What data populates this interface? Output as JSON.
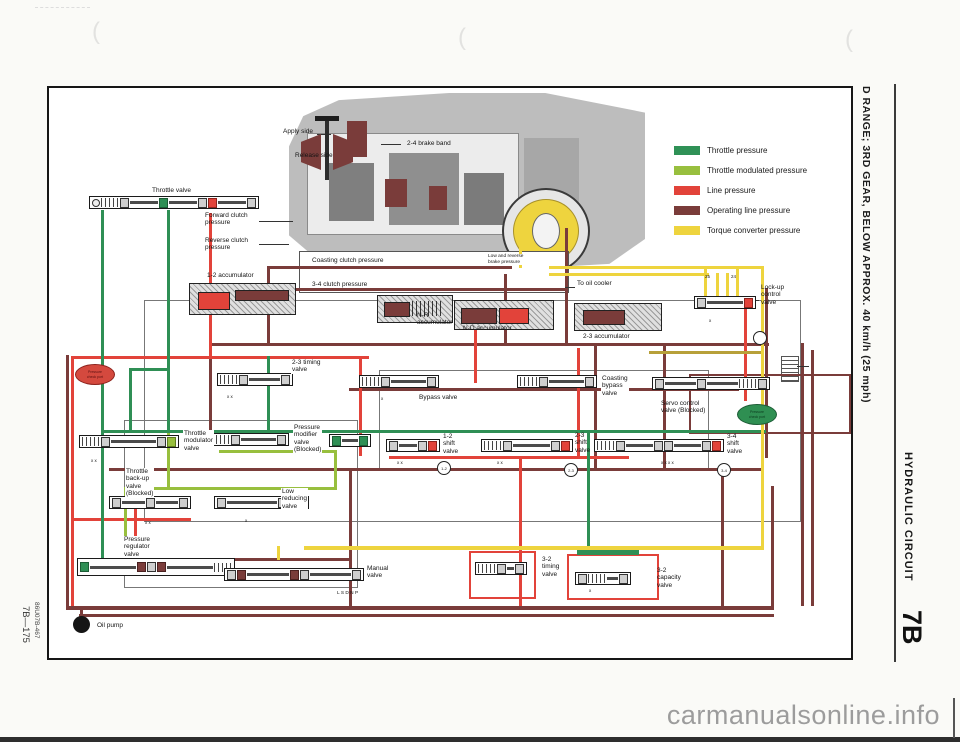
{
  "page": {
    "margin_left": {
      "page_number": "7B—175",
      "figure_code": "86U07B-467"
    },
    "margin_right": {
      "caption": "D RANGE; 3RD GEAR, BELOW APPROX. 40 km/h (25 mph)",
      "section_title": "HYDRAULIC CIRCUIT",
      "section_number": "7B"
    },
    "watermark": "carmanualsonline.info"
  },
  "legend": {
    "items": [
      {
        "label": "Throttle pressure",
        "color": "#2f9156"
      },
      {
        "label": "Throttle modulated pressure",
        "color": "#98bf3e"
      },
      {
        "label": "Line pressure",
        "color": "#e2433a"
      },
      {
        "label": "Operating line pressure",
        "color": "#7a3c3a"
      },
      {
        "label": "Torque converter pressure",
        "color": "#eed43e"
      }
    ]
  },
  "diagram": {
    "labels": [
      {
        "t": "Apply side",
        "x": 234,
        "y": 40
      },
      {
        "t": "Release side",
        "x": 246,
        "y": 64
      },
      {
        "t": "2-4 brake band",
        "x": 358,
        "y": 52
      },
      {
        "t": "Throttle valve",
        "x": 103,
        "y": 99
      },
      {
        "t": "Forward clutch\npressure",
        "x": 156,
        "y": 124
      },
      {
        "t": "Reverse clutch\npressure",
        "x": 156,
        "y": 149
      },
      {
        "t": "1-2 accumulator",
        "x": 158,
        "y": 184
      },
      {
        "t": "Coasting clutch pressure",
        "x": 262,
        "y": 169,
        "bg": 1
      },
      {
        "t": "Low and reverse\nbrake pressure",
        "x": 438,
        "y": 166,
        "s": 4.8,
        "bg": 1
      },
      {
        "t": "3-4 clutch pressure",
        "x": 262,
        "y": 193,
        "bg": 1
      },
      {
        "t": "To oil cooler",
        "x": 528,
        "y": 192
      },
      {
        "t": "N-R\naccumulator",
        "x": 368,
        "y": 224
      },
      {
        "t": "N-D accumulator",
        "x": 414,
        "y": 237
      },
      {
        "t": "2-3 accumulator",
        "x": 534,
        "y": 245
      },
      {
        "t": "Lock-up\ncontrol\nvalve",
        "x": 712,
        "y": 196
      },
      {
        "t": "2-3 timing\nvalve",
        "x": 242,
        "y": 271,
        "bg": 1
      },
      {
        "t": "Bypass valve",
        "x": 370,
        "y": 306
      },
      {
        "t": "Coasting\nbypass\nvalve",
        "x": 552,
        "y": 287,
        "bg": 1
      },
      {
        "t": "Servo control\nvalve (Blocked)",
        "x": 612,
        "y": 312
      },
      {
        "t": "Throttle\nmodulator\nvalve",
        "x": 134,
        "y": 342,
        "bg": 1
      },
      {
        "t": "Pressure\nmodifier\nvalve\n(Blocked)",
        "x": 244,
        "y": 336,
        "bg": 1
      },
      {
        "t": "1-2\nshift\nvalve",
        "x": 394,
        "y": 345
      },
      {
        "t": "2-3\nshift\nvalve",
        "x": 526,
        "y": 344
      },
      {
        "t": "3-4\nshift\nvalve",
        "x": 678,
        "y": 345
      },
      {
        "t": "Throttle\nback-up\nvalve\n(Blocked)",
        "x": 76,
        "y": 380,
        "bg": 1
      },
      {
        "t": "Low\nreducing\nvalve",
        "x": 232,
        "y": 400,
        "bg": 1
      },
      {
        "t": "Pressure\nregulator\nvalve",
        "x": 74,
        "y": 448,
        "bg": 1
      },
      {
        "t": "Manual\nvalve",
        "x": 318,
        "y": 477
      },
      {
        "t": "L   S   D   N   P",
        "x": 288,
        "y": 503,
        "s": 4.8
      },
      {
        "t": "3-2\ntiming\nvalve",
        "x": 492,
        "y": 468,
        "bg": 1
      },
      {
        "t": "3-2\ncapacity\nvalve",
        "x": 608,
        "y": 479
      },
      {
        "t": "Oil pump",
        "x": 48,
        "y": 534
      },
      {
        "t": "25",
        "x": 656,
        "y": 186,
        "s": 4.5
      },
      {
        "t": "24",
        "x": 682,
        "y": 186,
        "s": 4.5
      },
      {
        "t": "x    x",
        "x": 348,
        "y": 372,
        "s": 4.5
      },
      {
        "t": "x    x",
        "x": 448,
        "y": 372,
        "s": 4.5
      },
      {
        "t": "x  x  x  x",
        "x": 612,
        "y": 372,
        "s": 4.5
      },
      {
        "t": "x",
        "x": 660,
        "y": 230,
        "s": 4.5
      },
      {
        "t": "x    x",
        "x": 178,
        "y": 306,
        "s": 4.5
      },
      {
        "t": "x",
        "x": 332,
        "y": 308,
        "s": 4.5
      },
      {
        "t": "x    x",
        "x": 42,
        "y": 370,
        "s": 4.5
      },
      {
        "t": "x",
        "x": 196,
        "y": 430,
        "s": 4.5
      },
      {
        "t": "x",
        "x": 540,
        "y": 500,
        "s": 4.5
      },
      {
        "t": "x    x",
        "x": 96,
        "y": 432,
        "s": 4.5
      }
    ],
    "solenoids": [
      {
        "t": "1-2",
        "x": 388,
        "y": 373
      },
      {
        "t": "2-3",
        "x": 515,
        "y": 375
      },
      {
        "t": "3-4",
        "x": 668,
        "y": 375
      },
      {
        "t": "",
        "x": 704,
        "y": 243
      }
    ],
    "badges": [
      {
        "t": "Pressure\ncheck port",
        "x": 26,
        "y": 276,
        "color": "red"
      },
      {
        "t": "Pressure\ncheck port",
        "x": 688,
        "y": 316,
        "color": "green"
      }
    ]
  }
}
